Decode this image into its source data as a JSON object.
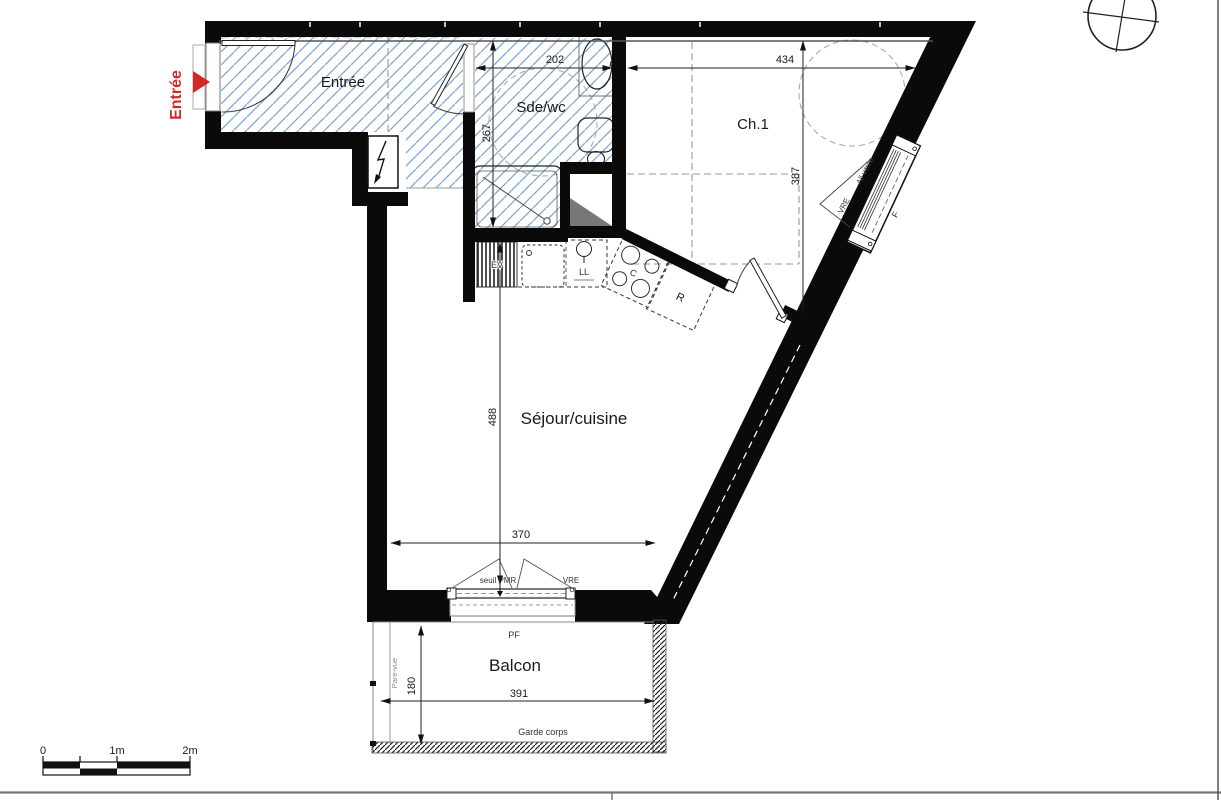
{
  "plan": {
    "rooms": {
      "entree": "Entrée",
      "sdewc": "Sde/wc",
      "ch1": "Ch.1",
      "sejour": "Séjour/cuisine",
      "balcon": "Balcon"
    },
    "dims": {
      "sdewc_width": "202",
      "sdewc_depth": "267",
      "ch1_width": "434",
      "ch1_depth": "387",
      "sejour_depth": "488",
      "sejour_bay_width": "370",
      "balcon_width": "391",
      "balcon_depth": "180"
    },
    "labels": {
      "entrance_arrow": "Entrée",
      "seuil": "seuil PMR",
      "vre_bay": "VRE",
      "pf": "PF",
      "garde_corps": "Garde corps",
      "pare_vue": "Pare-vue",
      "sink": "EV",
      "washer": "LL",
      "cooktop": "C",
      "fridge": "R",
      "vre_window": "VRE",
      "allege": "All.vitrée",
      "fenetre": "F"
    },
    "scale_bar": {
      "zero": "0",
      "one": "1m",
      "two": "2m"
    },
    "colors": {
      "wall": "#0a0a0a",
      "tile_hatch": "#7aa7d8",
      "entrance_red": "#d22727",
      "dash_gray": "#999999"
    }
  }
}
